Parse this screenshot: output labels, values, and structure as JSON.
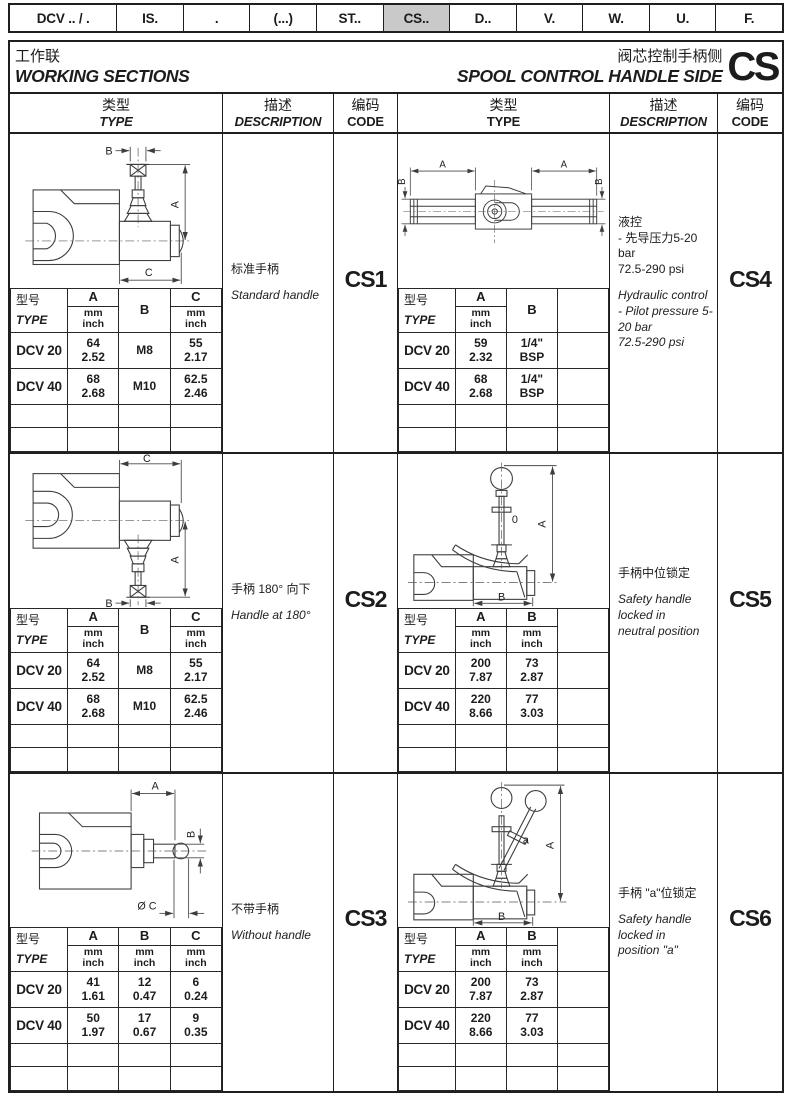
{
  "tabs": [
    {
      "label": "DCV .. / .",
      "active": false
    },
    {
      "label": "IS.",
      "active": false
    },
    {
      "label": ".",
      "active": false
    },
    {
      "label": "(...)",
      "active": false
    },
    {
      "label": "ST..",
      "active": false
    },
    {
      "label": "CS..",
      "active": true
    },
    {
      "label": "D..",
      "active": false
    },
    {
      "label": "V.",
      "active": false
    },
    {
      "label": "W.",
      "active": false
    },
    {
      "label": "U.",
      "active": false
    },
    {
      "label": "F.",
      "active": false
    }
  ],
  "header": {
    "title_zh": "工作联",
    "title_en": "WORKING SECTIONS",
    "subtitle_zh": "阀芯控制手柄侧",
    "subtitle_en": "SPOOL CONTROL HANDLE SIDE",
    "code": "CS"
  },
  "column_headers": {
    "type_zh": "类型",
    "type_en": "TYPE",
    "desc_zh": "描述",
    "desc_en": "DESCRIPTION",
    "code_zh": "编码",
    "code_en": "CODE"
  },
  "table_labels": {
    "corner_zh": "型号",
    "corner_en": "TYPE",
    "unit_mm": "mm",
    "unit_inch": "inch"
  },
  "colors": {
    "line": "#1f1f1f",
    "tab_active_bg": "#c9c9c9",
    "paper": "#ffffff"
  },
  "blocks": [
    {
      "code": "CS1",
      "diagram": "cs1",
      "diagram_labels": [
        "B",
        "A",
        "C"
      ],
      "desc_zh": "标准手柄",
      "desc_en": "Standard handle",
      "columns": [
        {
          "letter": "A",
          "units": true
        },
        {
          "letter": "B",
          "units": false
        },
        {
          "letter": "C",
          "units": true
        }
      ],
      "rows": [
        {
          "model": "DCV 20",
          "cells": [
            [
              "64",
              "2.52"
            ],
            [
              "M8"
            ],
            [
              "55",
              "2.17"
            ]
          ]
        },
        {
          "model": "DCV 40",
          "cells": [
            [
              "68",
              "2.68"
            ],
            [
              "M10"
            ],
            [
              "62.5",
              "2.46"
            ]
          ]
        }
      ]
    },
    {
      "code": "CS4",
      "diagram": "cs4",
      "diagram_labels": [
        "A",
        "A",
        "B",
        "B"
      ],
      "desc_zh": "液控\n- 先导压力5-20 bar\n72.5-290 psi",
      "desc_en": "Hydraulic control\n- Pilot pressure 5-20 bar\n72.5-290 psi",
      "columns": [
        {
          "letter": "A",
          "units": true
        },
        {
          "letter": "B",
          "units": false
        },
        {
          "letter": "",
          "units": false
        }
      ],
      "rows": [
        {
          "model": "DCV 20",
          "cells": [
            [
              "59",
              "2.32"
            ],
            [
              "1/4\" BSP"
            ],
            []
          ]
        },
        {
          "model": "DCV 40",
          "cells": [
            [
              "68",
              "2.68"
            ],
            [
              "1/4\" BSP"
            ],
            []
          ]
        }
      ]
    },
    {
      "code": "CS2",
      "diagram": "cs2",
      "diagram_labels": [
        "C",
        "A",
        "B"
      ],
      "desc_zh": "手柄 180° 向下",
      "desc_en": "Handle at 180°",
      "columns": [
        {
          "letter": "A",
          "units": true
        },
        {
          "letter": "B",
          "units": false
        },
        {
          "letter": "C",
          "units": true
        }
      ],
      "rows": [
        {
          "model": "DCV 20",
          "cells": [
            [
              "64",
              "2.52"
            ],
            [
              "M8"
            ],
            [
              "55",
              "2.17"
            ]
          ]
        },
        {
          "model": "DCV 40",
          "cells": [
            [
              "68",
              "2.68"
            ],
            [
              "M10"
            ],
            [
              "62.5",
              "2.46"
            ]
          ]
        }
      ]
    },
    {
      "code": "CS5",
      "diagram": "cs5",
      "diagram_labels": [
        "A",
        "B",
        "0"
      ],
      "desc_zh": "手柄中位锁定",
      "desc_en": "Safety handle locked in\nneutral position",
      "columns": [
        {
          "letter": "A",
          "units": true
        },
        {
          "letter": "B",
          "units": true
        },
        {
          "letter": "",
          "units": false
        }
      ],
      "rows": [
        {
          "model": "DCV 20",
          "cells": [
            [
              "200",
              "7.87"
            ],
            [
              "73",
              "2.87"
            ],
            []
          ]
        },
        {
          "model": "DCV 40",
          "cells": [
            [
              "220",
              "8.66"
            ],
            [
              "77",
              "3.03"
            ],
            []
          ]
        }
      ]
    },
    {
      "code": "CS3",
      "diagram": "cs3",
      "diagram_labels": [
        "A",
        "B",
        "Ø C"
      ],
      "desc_zh": "不带手柄",
      "desc_en": "Without handle",
      "columns": [
        {
          "letter": "A",
          "units": true
        },
        {
          "letter": "B",
          "units": true
        },
        {
          "letter": "C",
          "units": true
        }
      ],
      "rows": [
        {
          "model": "DCV 20",
          "cells": [
            [
              "41",
              "1.61"
            ],
            [
              "12",
              "0.47"
            ],
            [
              "6",
              "0.24"
            ]
          ]
        },
        {
          "model": "DCV 40",
          "cells": [
            [
              "50",
              "1.97"
            ],
            [
              "17",
              "0.67"
            ],
            [
              "9",
              "0.35"
            ]
          ]
        }
      ]
    },
    {
      "code": "CS6",
      "diagram": "cs6",
      "diagram_labels": [
        "A",
        "B",
        "a"
      ],
      "desc_zh": "手柄 \"a\"位锁定",
      "desc_en": "Safety handle locked in\nposition \"a\"",
      "columns": [
        {
          "letter": "A",
          "units": true
        },
        {
          "letter": "B",
          "units": true
        },
        {
          "letter": "",
          "units": false
        }
      ],
      "rows": [
        {
          "model": "DCV 20",
          "cells": [
            [
              "200",
              "7.87"
            ],
            [
              "73",
              "2.87"
            ],
            []
          ]
        },
        {
          "model": "DCV 40",
          "cells": [
            [
              "220",
              "8.66"
            ],
            [
              "77",
              "3.03"
            ],
            []
          ]
        }
      ]
    }
  ]
}
